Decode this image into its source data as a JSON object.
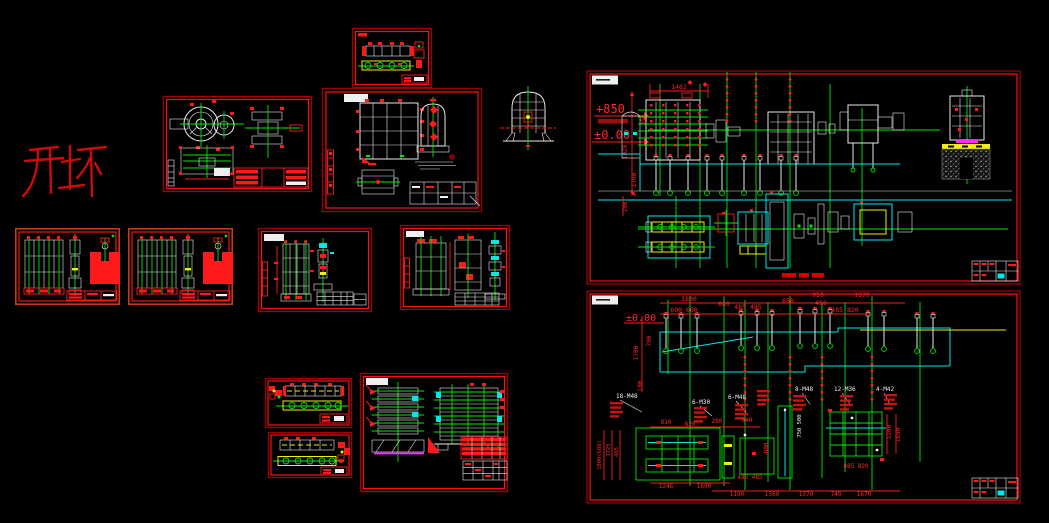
{
  "annotations": {
    "kaipi_text": "开坯"
  },
  "colors": {
    "background": "#000000",
    "entity_white": "#e9e9e9",
    "centerline_green": "#00e800",
    "foundation_cyan": "#00e8e8",
    "roller_yellow": "#f0f000",
    "dimension_red": "#ff1a1a",
    "border_red": "#ff0f0f",
    "border_dark_red": "#9c0000",
    "magenta": "#ff2aff",
    "hatch_gray": "#999999"
  },
  "sheets": {
    "mill_line": {
      "level_upper": "+850",
      "level_zero": "±0.00",
      "dim_top": "1462",
      "dim_left_rot": [
        "1020",
        "350",
        "1700"
      ],
      "dim_plan": "100"
    },
    "foundation": {
      "level_zero": "±0.00",
      "dims_top": [
        "1800",
        "600 600",
        "800",
        "485 485",
        "650",
        "950",
        "450",
        "1670",
        "485 820"
      ],
      "dims_left_rot": [
        "700",
        "1700",
        "100"
      ],
      "bolt_labels": [
        "18-M48",
        "6-M30",
        "6-M48",
        "8-M48",
        "12-M36",
        "4-M42"
      ],
      "dims_plan_top": [
        "810",
        "820",
        "280",
        "840"
      ],
      "dims_plan_rot": [
        "800",
        "1800(680)",
        "1725",
        "465",
        "750 500",
        "1200",
        "1690"
      ],
      "dims_plan_mid": [
        "485 485",
        "485 820"
      ],
      "dims_plan_bottom": [
        "1246",
        "1600",
        "1190",
        "1360",
        "1370",
        "740",
        "1670"
      ]
    }
  }
}
